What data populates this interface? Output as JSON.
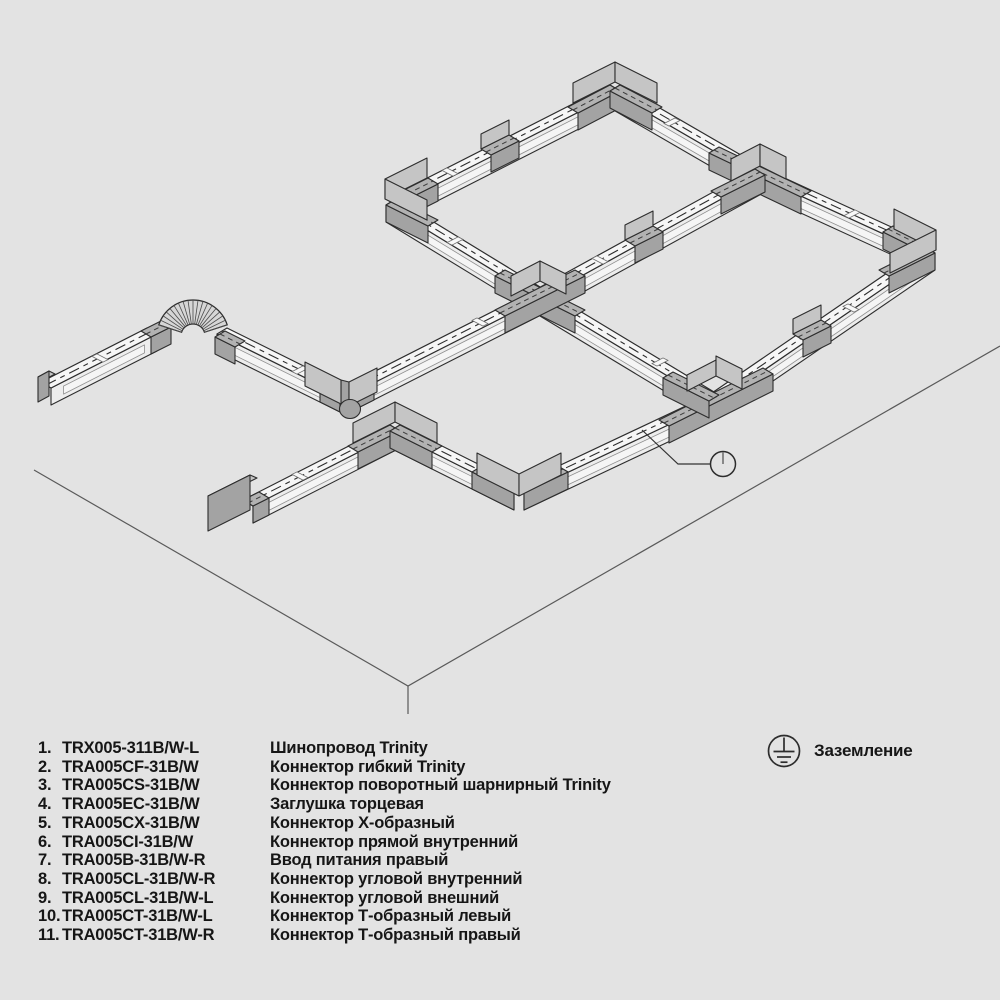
{
  "diagram": {
    "callouts": [
      {
        "n": "9",
        "x": 681,
        "y": 38,
        "s": -1,
        "tx": 622,
        "ty": 90
      },
      {
        "n": "1",
        "x": 502,
        "y": 62,
        "s": 1,
        "tx": 556,
        "ty": 104
      },
      {
        "n": "6",
        "x": 449,
        "y": 92,
        "s": 1,
        "tx": 496,
        "ty": 129
      },
      {
        "n": "1",
        "x": 394,
        "y": 125,
        "s": 1,
        "tx": 447,
        "ty": 169
      },
      {
        "n": "1",
        "x": 740,
        "y": 72,
        "s": -1,
        "tx": 691,
        "ty": 127
      },
      {
        "n": "11",
        "x": 816,
        "y": 115,
        "s": -1,
        "tx": 767,
        "ty": 167
      },
      {
        "n": "1",
        "x": 897,
        "y": 163,
        "s": -1,
        "tx": 852,
        "ty": 213
      },
      {
        "n": "9",
        "x": 958,
        "y": 197,
        "s": -1,
        "tx": 936,
        "ty": 246
      },
      {
        "n": "9",
        "x": 339,
        "y": 157,
        "s": 1,
        "tx": 385,
        "ty": 196
      },
      {
        "n": "6",
        "x": 586,
        "y": 180,
        "s": 1,
        "tx": 644,
        "ty": 227
      },
      {
        "n": "5",
        "x": 558,
        "y": 225,
        "s": -1,
        "tx": 513,
        "ty": 259
      },
      {
        "n": "1",
        "x": 729,
        "y": 228,
        "s": -1,
        "tx": 694,
        "ty": 216
      },
      {
        "n": "1",
        "x": 650,
        "y": 273,
        "s": -1,
        "tx": 607,
        "ty": 315
      },
      {
        "n": "2",
        "x": 267,
        "y": 269,
        "s": -1,
        "tx": 220,
        "ty": 307
      },
      {
        "n": "1",
        "x": 320,
        "y": 300,
        "s": -1,
        "tx": 273,
        "ty": 338
      },
      {
        "n": "3",
        "x": 368,
        "y": 327,
        "s": -1,
        "tx": 325,
        "ty": 363
      },
      {
        "n": "1",
        "x": 406,
        "y": 272,
        "s": 1,
        "tx": 452,
        "ty": 336
      },
      {
        "n": "1",
        "x": 166,
        "y": 377,
        "s": -1,
        "tx": 126,
        "ty": 357
      },
      {
        "n": "4",
        "x": 94,
        "y": 418,
        "s": -1,
        "tx": 48,
        "ty": 396
      },
      {
        "n": "1",
        "x": 478,
        "y": 375,
        "s": -1,
        "tx": 443,
        "ty": 424
      },
      {
        "n": "8",
        "x": 483,
        "y": 409,
        "s": -1,
        "tx": 430,
        "ty": 449
      },
      {
        "n": "9",
        "x": 543,
        "y": 444,
        "s": -1,
        "tx": 522,
        "ty": 480
      },
      {
        "n": "1",
        "x": 573,
        "y": 372,
        "s": 1,
        "tx": 654,
        "ty": 420
      },
      {
        "n": "1",
        "x": 637,
        "y": 494,
        "s": -1,
        "tx": 598,
        "ty": 462
      },
      {
        "n": "6",
        "x": 768,
        "y": 291,
        "s": 1,
        "tx": 812,
        "ty": 326
      },
      {
        "n": "10",
        "x": 743,
        "y": 330,
        "s": -1,
        "tx": 700,
        "ty": 368
      },
      {
        "n": "1",
        "x": 911,
        "y": 337,
        "s": -1,
        "tx": 858,
        "ty": 322
      },
      {
        "n": "1",
        "x": 812,
        "y": 393,
        "s": -1,
        "tx": 763,
        "ty": 380
      },
      {
        "n": "7",
        "x": 190,
        "y": 478,
        "s": 1,
        "tx": 226,
        "ty": 506
      },
      {
        "n": "1",
        "x": 246,
        "y": 447,
        "s": 1,
        "tx": 289,
        "ty": 479
      },
      {
        "n": "1",
        "x": 413,
        "y": 499,
        "s": 1,
        "tx": 465,
        "ty": 477
      }
    ]
  },
  "legend": {
    "items": [
      {
        "num": "1.",
        "code": "TRX005-311B/W-L",
        "desc": "Шинопровод Trinity"
      },
      {
        "num": "2.",
        "code": "TRA005CF-31B/W",
        "desc": "Коннектор гибкий Trinity"
      },
      {
        "num": "3.",
        "code": "TRA005CS-31B/W",
        "desc": "Коннектор поворотный шарнирный Trinity"
      },
      {
        "num": "4.",
        "code": "TRA005EC-31B/W",
        "desc": "Заглушка торцевая"
      },
      {
        "num": "5.",
        "code": "TRA005CX-31B/W",
        "desc": "Коннектор Х-образный"
      },
      {
        "num": "6.",
        "code": "TRA005CI-31B/W",
        "desc": "Коннектор прямой внутренний"
      },
      {
        "num": "7.",
        "code": "TRA005B-31B/W-R",
        "desc": "Ввод питания правый"
      },
      {
        "num": "8.",
        "code": "TRA005CL-31B/W-R",
        "desc": "Коннектор угловой внутренний"
      },
      {
        "num": "9.",
        "code": "TRA005CL-31B/W-L",
        "desc": "Коннектор угловой внешний"
      },
      {
        "num": "10.",
        "code": "TRA005CT-31B/W-L",
        "desc": "Коннектор Т-образный левый"
      },
      {
        "num": "11.",
        "code": "TRA005CT-31B/W-R",
        "desc": "Коннектор Т-образный правый"
      }
    ],
    "ground_label": "Заземление"
  },
  "colors": {
    "background": "#e3e3e3",
    "line": "#2d2d2d",
    "track_top": "#f6f6f6",
    "connector": "#b2b2b2",
    "callout_bg": "#101010",
    "callout_text": "#ffffff"
  }
}
